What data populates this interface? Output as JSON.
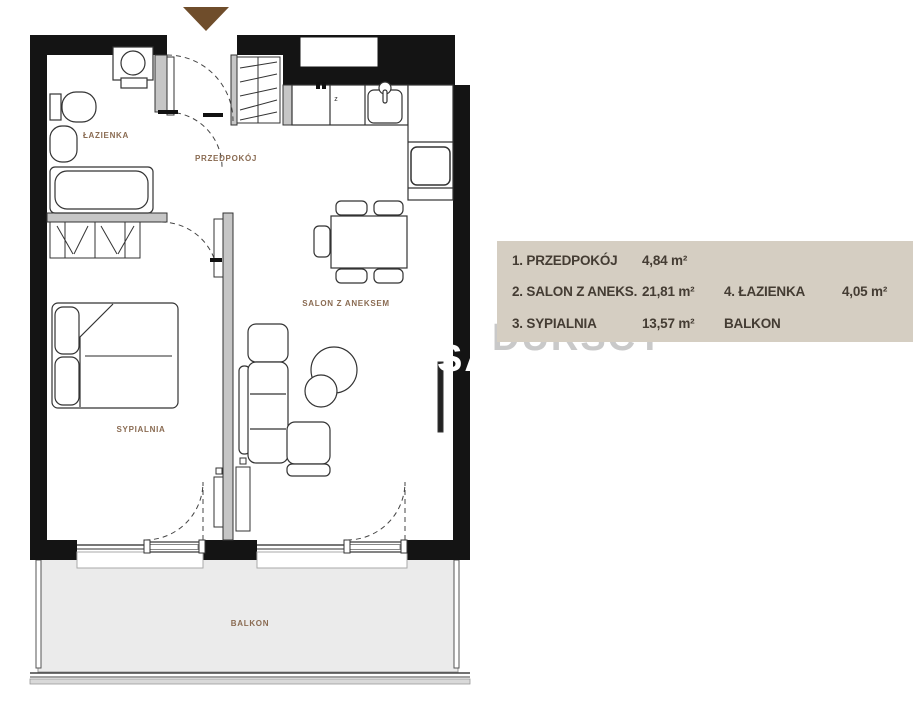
{
  "plan": {
    "rooms": {
      "lazienka": "ŁAZIENKA",
      "przedpokoj": "PRZEDPOKÓJ",
      "salon": "SALON Z ANEKSEM",
      "sypialnia": "SYPIALNIA",
      "balkon": "BALKON"
    },
    "kitchen_mark": "z",
    "arrow_color": "#6f4d2b",
    "label_color": "#8a6b52"
  },
  "legend": {
    "bg_color": "#d5cec2",
    "text_color": "#443c33",
    "rows": [
      {
        "label1": "1. PRZEDPOKÓJ",
        "value1": "4,84 m²",
        "label2": "",
        "value2": ""
      },
      {
        "label1": "2. SALON Z ANEKS.",
        "value1": "21,81 m²",
        "label2": "4. ŁAZIENKA",
        "value2": "4,05 m²"
      },
      {
        "label1": "3. SYPIALNIA",
        "value1": "13,57 m²",
        "label2": "BALKON",
        "value2": ""
      }
    ]
  },
  "watermark": {
    "sa": "SA",
    "rest": "DURSCY"
  }
}
